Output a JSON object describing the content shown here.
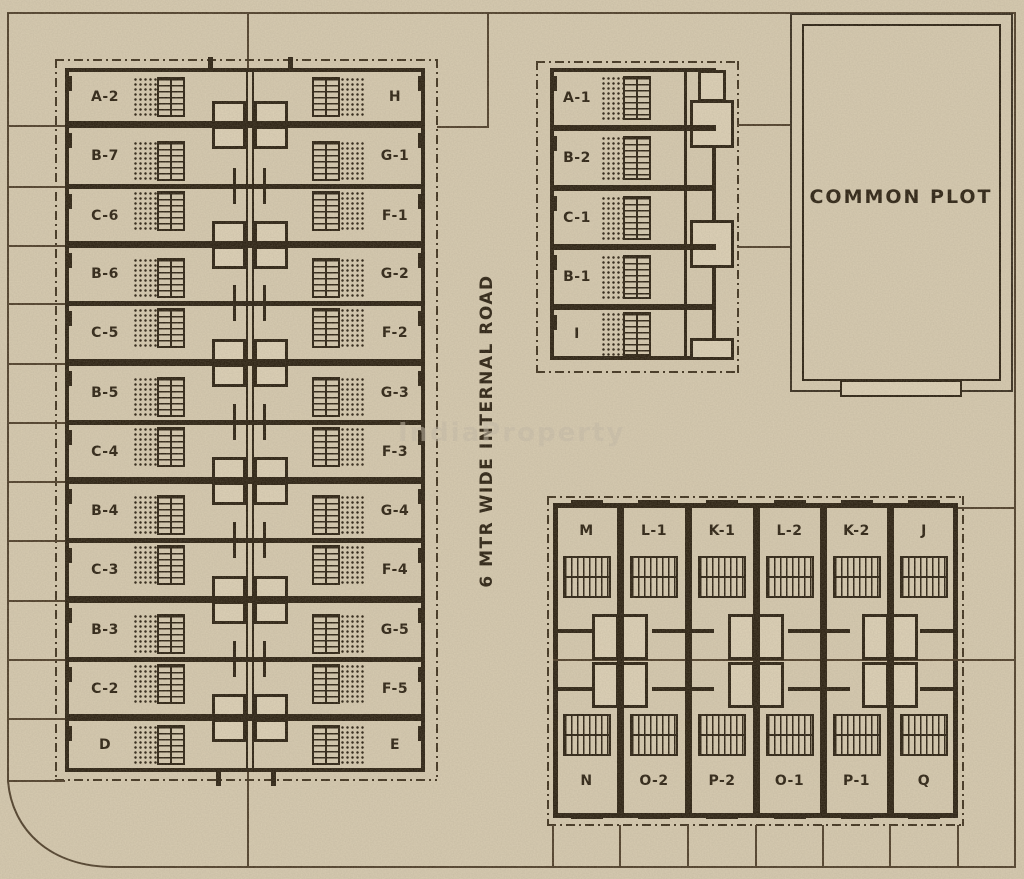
{
  "road": {
    "label": "6 MTR WIDE INTERNAL ROAD"
  },
  "common_plot": {
    "label": "COMMON PLOT"
  },
  "watermark": {
    "text": "IndiaProperty"
  },
  "left_block": {
    "rows": [
      {
        "left": "A-2",
        "right": "H"
      },
      {
        "left": "B-7",
        "right": "G-1"
      },
      {
        "left": "C-6",
        "right": "F-1"
      },
      {
        "left": "B-6",
        "right": "G-2"
      },
      {
        "left": "C-5",
        "right": "F-2"
      },
      {
        "left": "B-5",
        "right": "G-3"
      },
      {
        "left": "C-4",
        "right": "F-3"
      },
      {
        "left": "B-4",
        "right": "G-4"
      },
      {
        "left": "C-3",
        "right": "F-4"
      },
      {
        "left": "B-3",
        "right": "G-5"
      },
      {
        "left": "C-2",
        "right": "F-5"
      },
      {
        "left": "D",
        "right": "E"
      }
    ]
  },
  "north_block": {
    "units": [
      "A-1",
      "B-2",
      "C-1",
      "B-1",
      "I"
    ]
  },
  "south_block": {
    "top_row": [
      "M",
      "L-1",
      "K-1",
      "L-2",
      "K-2",
      "J"
    ],
    "bottom_row": [
      "N",
      "O-2",
      "P-2",
      "O-1",
      "P-1",
      "Q"
    ]
  },
  "colors": {
    "paper": "#d8ccb2",
    "ink": "#241a0c"
  }
}
